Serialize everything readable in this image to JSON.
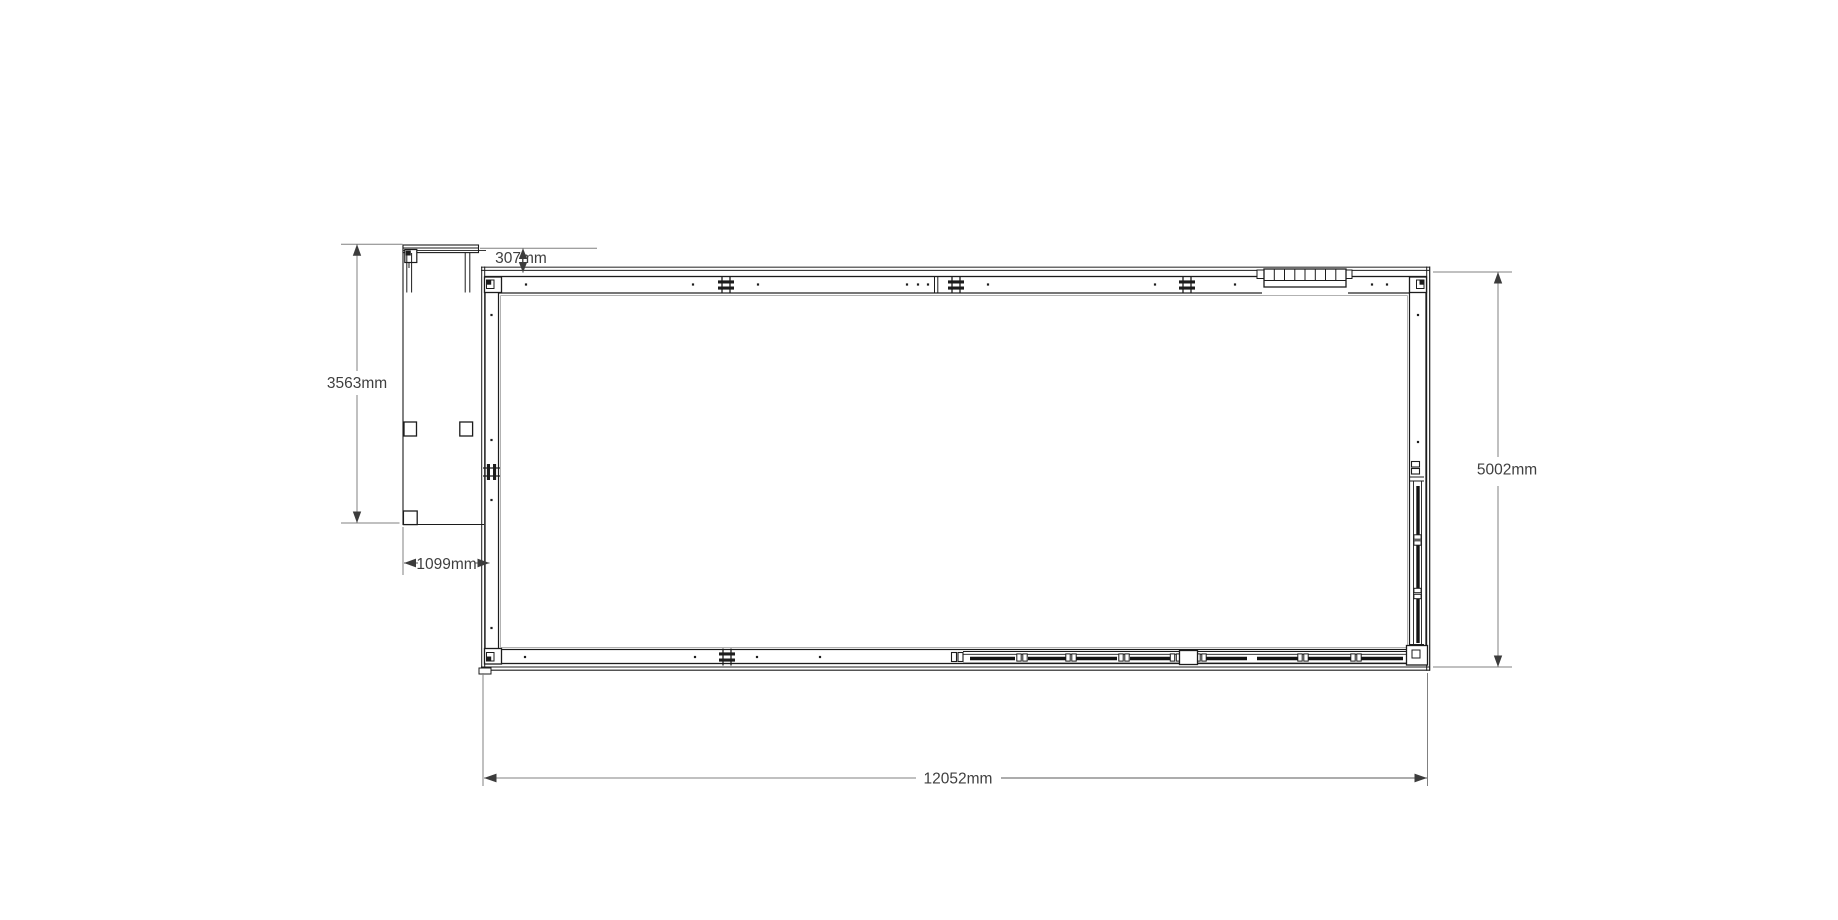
{
  "drawing": {
    "type": "architectural-floor-plan",
    "view": "plan",
    "dimension_labels": {
      "overall_width": "12052mm",
      "overall_depth": "5002mm",
      "annex_depth": "3563mm",
      "annex_width": "1099mm",
      "canopy_offset": "307mm"
    },
    "features": {
      "main_building": "rectangular modular building shell",
      "annex": "open porch / canopy annex on left side",
      "top_wall": "wall with stud marks, three panel joints and clerestory window",
      "bottom_wall": "wall with sliding glazed door section and pier",
      "right_wall": "wall with vertical glazed sliding door",
      "window": "segmented window unit top right"
    },
    "colors": {
      "linework": "#1c1c1c",
      "glazing": "#141414",
      "dimension_line": "#808080",
      "dimension_text": "#3f3f3f",
      "background": "#ffffff"
    }
  }
}
